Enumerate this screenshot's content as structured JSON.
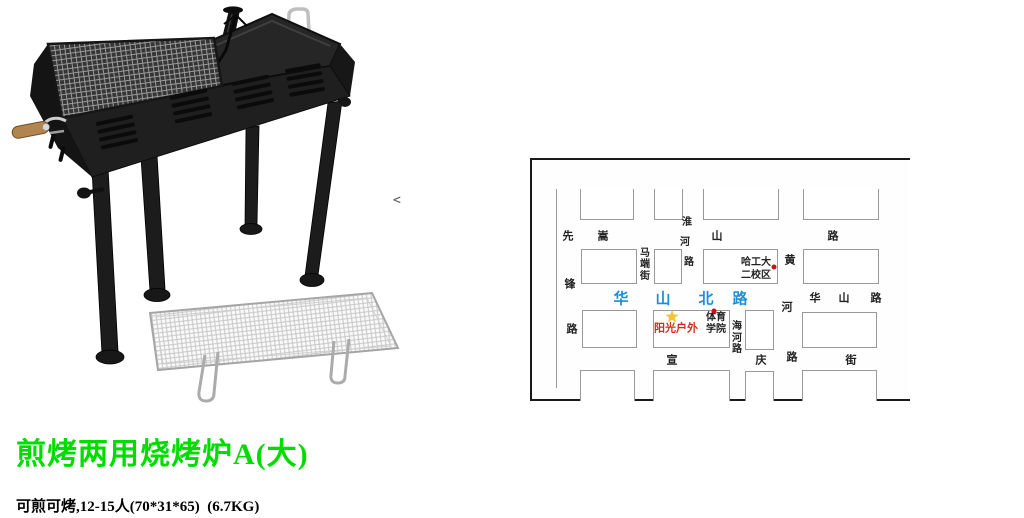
{
  "theme": {
    "title_green": "#00DC00",
    "map_highlight_blue": "#1E8FD5",
    "marker_red": "#CC1111",
    "star_gold": "#F5C431",
    "landmark_red_text": "#D02E1C",
    "map_label_dark": "#222222",
    "block_border_gray": "#999999",
    "map_border_dark": "#1A1A1A"
  },
  "product": {
    "title": "煎烤两用烧烤炉A(大)",
    "specs_line": "可煎可烤,12-15人(70*31*65)  (6.7KG)",
    "carousel_arrow": "<"
  },
  "map": {
    "road_line": {
      "x": 24,
      "y1": 29,
      "y2": 228
    },
    "blocks": [
      {
        "x": 48,
        "y": 29,
        "w": 54,
        "h": 31,
        "open": "top"
      },
      {
        "x": 122,
        "y": 29,
        "w": 29,
        "h": 31,
        "open": "top"
      },
      {
        "x": 171,
        "y": 29,
        "w": 76,
        "h": 31,
        "open": "top"
      },
      {
        "x": 271,
        "y": 29,
        "w": 76,
        "h": 31,
        "open": "top"
      },
      {
        "x": 49,
        "y": 89,
        "w": 56,
        "h": 35
      },
      {
        "x": 122,
        "y": 89,
        "w": 28,
        "h": 35
      },
      {
        "x": 171,
        "y": 89,
        "w": 75,
        "h": 35
      },
      {
        "x": 271,
        "y": 89,
        "w": 76,
        "h": 35
      },
      {
        "x": 50,
        "y": 150,
        "w": 55,
        "h": 38
      },
      {
        "x": 121,
        "y": 150,
        "w": 77,
        "h": 38
      },
      {
        "x": 213,
        "y": 150,
        "w": 29,
        "h": 40
      },
      {
        "x": 270,
        "y": 152,
        "w": 75,
        "h": 36
      },
      {
        "x": 48,
        "y": 210,
        "w": 55,
        "h": 31,
        "open": "bottom"
      },
      {
        "x": 121,
        "y": 210,
        "w": 77,
        "h": 31,
        "open": "bottom"
      },
      {
        "x": 213,
        "y": 211,
        "w": 29,
        "h": 30,
        "open": "bottom"
      },
      {
        "x": 270,
        "y": 210,
        "w": 75,
        "h": 31,
        "open": "bottom"
      }
    ],
    "roads": [
      {
        "id": "xianfeng-road",
        "size": 11,
        "chars": [
          {
            "t": "先",
            "x": 36,
            "y": 77
          },
          {
            "t": "锋",
            "x": 38,
            "y": 125
          },
          {
            "t": "路",
            "x": 40,
            "y": 170
          }
        ]
      },
      {
        "id": "songshan-road",
        "size": 11,
        "chars": [
          {
            "t": "嵩",
            "x": 71,
            "y": 77
          },
          {
            "t": "山",
            "x": 185,
            "y": 77
          },
          {
            "t": "路",
            "x": 301,
            "y": 77
          }
        ]
      },
      {
        "id": "maduan-street",
        "size": 10,
        "chars": [
          {
            "t": "马",
            "x": 113,
            "y": 94
          },
          {
            "t": "端",
            "x": 113,
            "y": 105
          },
          {
            "t": "街",
            "x": 113,
            "y": 117
          }
        ]
      },
      {
        "id": "huaihe-road",
        "size": 10,
        "chars": [
          {
            "t": "淮",
            "x": 155,
            "y": 63
          },
          {
            "t": "河",
            "x": 153,
            "y": 83
          },
          {
            "t": "路",
            "x": 157,
            "y": 103
          }
        ]
      },
      {
        "id": "huanghe-road",
        "size": 11,
        "chars": [
          {
            "t": "黄",
            "x": 258,
            "y": 101
          },
          {
            "t": "河",
            "x": 255,
            "y": 148
          },
          {
            "t": "路",
            "x": 260,
            "y": 198
          }
        ]
      },
      {
        "id": "haihe-road",
        "size": 10,
        "chars": [
          {
            "t": "海",
            "x": 205,
            "y": 167
          },
          {
            "t": "河",
            "x": 205,
            "y": 179
          },
          {
            "t": "路",
            "x": 205,
            "y": 190
          }
        ]
      },
      {
        "id": "huashan-north-road",
        "size": 15,
        "color": "#1E8FD5",
        "chars": [
          {
            "t": "华",
            "x": 89,
            "y": 139
          },
          {
            "t": "山",
            "x": 131,
            "y": 139
          },
          {
            "t": "北",
            "x": 174,
            "y": 139
          },
          {
            "t": "路",
            "x": 208,
            "y": 139
          }
        ]
      },
      {
        "id": "huashan-road",
        "size": 11,
        "chars": [
          {
            "t": "华",
            "x": 283,
            "y": 139
          },
          {
            "t": "山",
            "x": 312,
            "y": 139
          },
          {
            "t": "路",
            "x": 344,
            "y": 139
          }
        ]
      },
      {
        "id": "xuanqing-street",
        "size": 11,
        "chars": [
          {
            "t": "宣",
            "x": 140,
            "y": 201
          },
          {
            "t": "庆",
            "x": 229,
            "y": 201
          },
          {
            "t": "街",
            "x": 319,
            "y": 201
          }
        ]
      }
    ],
    "places": [
      {
        "id": "hit-second-campus",
        "lines": [
          "哈工大",
          "二校区"
        ],
        "x": 224,
        "y": 103,
        "lh": 13,
        "size": 10,
        "color": "#222222"
      },
      {
        "id": "sports-institute",
        "lines": [
          "体育",
          "学院"
        ],
        "x": 184,
        "y": 158,
        "lh": 12,
        "size": 10,
        "color": "#222222"
      },
      {
        "id": "sunshine-outdoor",
        "lines": [
          "阳光户外"
        ],
        "x": 144,
        "y": 169,
        "lh": 12,
        "size": 11,
        "color": "#D02E1C"
      }
    ],
    "markers": {
      "star": {
        "x": 140,
        "y": 158,
        "glyph": "★"
      },
      "dots": [
        {
          "x": 242,
          "y": 107
        },
        {
          "x": 182,
          "y": 151
        }
      ]
    }
  }
}
